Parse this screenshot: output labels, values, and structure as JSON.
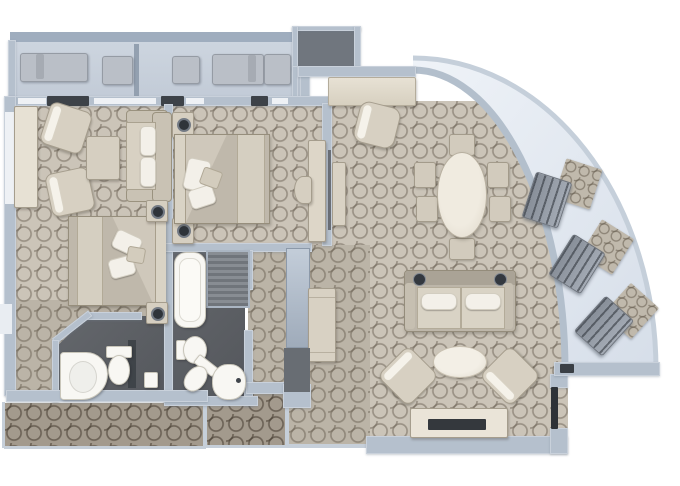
{
  "plan": {
    "title": "Two-bedroom suite floor plan with curved veranda",
    "canvas": {
      "width": 680,
      "height": 486
    },
    "palette": {
      "wall": "#b5c0cd",
      "carpet": "#cbc4b8",
      "carpet_corridor": "#a39a8d",
      "bathroom_floor": "#5a5d62",
      "balcony_floor": "#c9d2dc",
      "veranda_floor": "#e6ecf4",
      "furniture": "#d6cfc1",
      "fixture_white": "#f8f7f3",
      "dark_accent": "#2e3237"
    },
    "rooms": {
      "top_balcony": {
        "name": "Top balcony",
        "furniture": [
          "sun lounger",
          "side table",
          "side table",
          "sun lounger",
          "ottoman"
        ]
      },
      "second_bedroom": {
        "name": "Second bedroom with sitting area",
        "furniture": [
          "vanity counter",
          "armchair",
          "armchair",
          "coffee table",
          "loveseat sofa",
          "queen bed",
          "nightstand",
          "nightstand"
        ]
      },
      "master_bedroom": {
        "name": "Master bedroom",
        "furniture": [
          "queen bed",
          "nightstand",
          "nightstand",
          "vanity desk",
          "stool",
          "wall console"
        ]
      },
      "master_bathroom": {
        "name": "Master bathroom",
        "fixtures": [
          "bathtub",
          "shower",
          "bidet",
          "toilet",
          "basin"
        ]
      },
      "guest_bathroom": {
        "name": "Guest bathroom",
        "fixtures": [
          "corner basin",
          "toilet",
          "dispenser"
        ]
      },
      "dressing_hall": {
        "name": "Dressing hallway",
        "furniture": [
          "mirror door",
          "wardrobe cabinet",
          "dark panel"
        ]
      },
      "living_room": {
        "name": "Living and dining room",
        "furniture": [
          "writing desk",
          "desk chair",
          "oval dining table",
          "dining chair",
          "dining chair",
          "dining chair",
          "dining chair",
          "dining chair",
          "dining chair",
          "sofa with reading lamps",
          "oval coffee table",
          "armchair",
          "armchair",
          "tv console",
          "tv"
        ]
      },
      "curved_veranda": {
        "name": "Curved veranda",
        "furniture": [
          "deck chair",
          "deck mat",
          "deck chair",
          "deck mat",
          "deck chair",
          "deck mat"
        ]
      },
      "entry_hall": {
        "name": "Entry hall"
      },
      "ship_corridor": {
        "name": "Ship corridor"
      },
      "upper_block": {
        "name": "Upper service block"
      }
    }
  }
}
